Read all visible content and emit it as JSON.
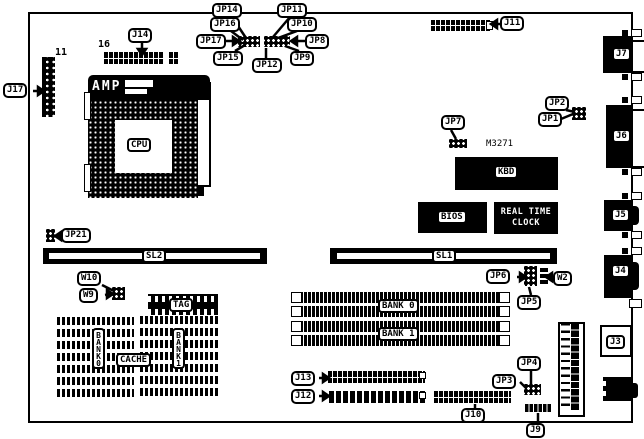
{
  "diagram_title": "motherboard-layout-diagram",
  "colors": {
    "ink": "#000000",
    "paper": "#ffffff"
  },
  "callouts": {
    "j17": "J17",
    "j14": "J14",
    "jp14": "JP14",
    "jp16": "JP16",
    "jp17": "JP17",
    "jp15": "JP15",
    "jp11": "JP11",
    "jp10": "JP10",
    "jp8": "JP8",
    "jp9": "JP9",
    "jp12": "JP12",
    "j11": "J11",
    "jp2": "JP2",
    "jp1": "JP1",
    "jp7": "JP7",
    "jp21": "JP21",
    "jp6": "JP6",
    "w2": "W2",
    "jp5": "JP5",
    "w10": "W10",
    "w9": "W9",
    "jp4": "JP4",
    "jp3": "JP3",
    "j13": "J13",
    "j12": "J12",
    "j10": "J10",
    "j9": "J9"
  },
  "chips": {
    "amp": "AMP",
    "cpu": "CPU",
    "kbd": "KBD",
    "bios": "BIOS",
    "rtc_line1": "REAL TIME",
    "rtc_line2": "CLOCK",
    "m3271": "M3271"
  },
  "slots": {
    "sl1": "SL1",
    "sl2": "SL2"
  },
  "memory": {
    "bank0": "BANK 0",
    "bank1": "BANK 1"
  },
  "cache": {
    "cache": "CACHE",
    "tag": "TAG",
    "bank0": "BANK0",
    "bank1": "BANK1"
  },
  "edge_connectors": {
    "j7": "J7",
    "j6": "J6",
    "j5": "J5",
    "j4": "J4",
    "j3": "J3"
  },
  "pin_labels": {
    "j17_pins": "11",
    "j14_pins": "16"
  }
}
